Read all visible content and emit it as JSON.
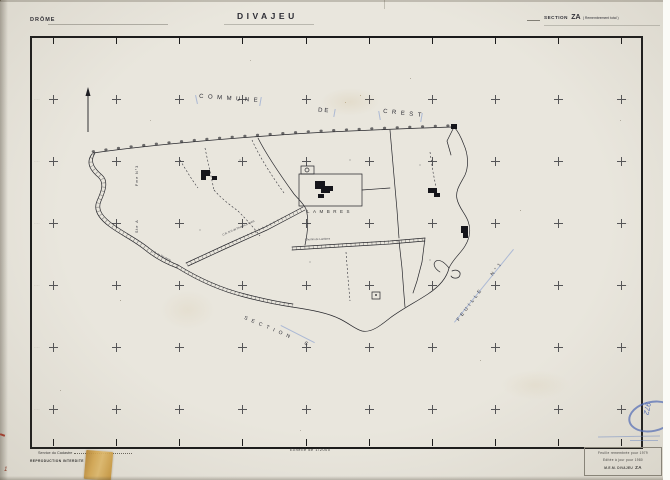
{
  "colors": {
    "paper": "#e9e6dd",
    "ink": "#26262b",
    "blue_pencil": "#5b79c0",
    "tape": "#c99a3e",
    "red_mark": "#8a3a28"
  },
  "header": {
    "department": "DRÔME",
    "title": "DIVAJEU",
    "section_label": "SECTION",
    "section_value": "ZA",
    "section_note": "( Remembrement total )"
  },
  "map": {
    "adjacent_commune": {
      "word1": "COMMUNE",
      "word2": "DE",
      "word3": "CREST"
    },
    "locality": "LAMBRES",
    "adjacent_section_word": "SECTION",
    "adjacent_section_letter": "C",
    "sheet_word": "FEUILLE",
    "sheet_number": "N°1",
    "margin_top_label": "Fme N°3",
    "margin_bottom_label": "Ste A",
    "road_label_1": "C.R. N°2 de Divajeu à Crest",
    "road_label_2": "Chemin de Lambres",
    "road_label_3": "C.R. de Ste Anne",
    "edge_tick_label": "····"
  },
  "grid": {
    "cols": [
      53,
      116,
      179,
      242,
      306,
      369,
      432,
      495,
      558,
      621
    ],
    "rows": [
      99,
      161,
      223,
      285,
      347,
      409
    ]
  },
  "footer": {
    "scale": "Echelle de 1/2000",
    "issuer": "Service du Cadastre",
    "notice": "REPRODUCTION INTERDITE"
  },
  "stamp": {
    "line1": "Feuille remembrée pour 1979",
    "line2": "Editée à jour pour 1980",
    "line3_label": "M.E.M. DIVAJEU",
    "line3_value": "ZA"
  },
  "annotations": {
    "blue_number": "972",
    "corner_mark": "1"
  }
}
